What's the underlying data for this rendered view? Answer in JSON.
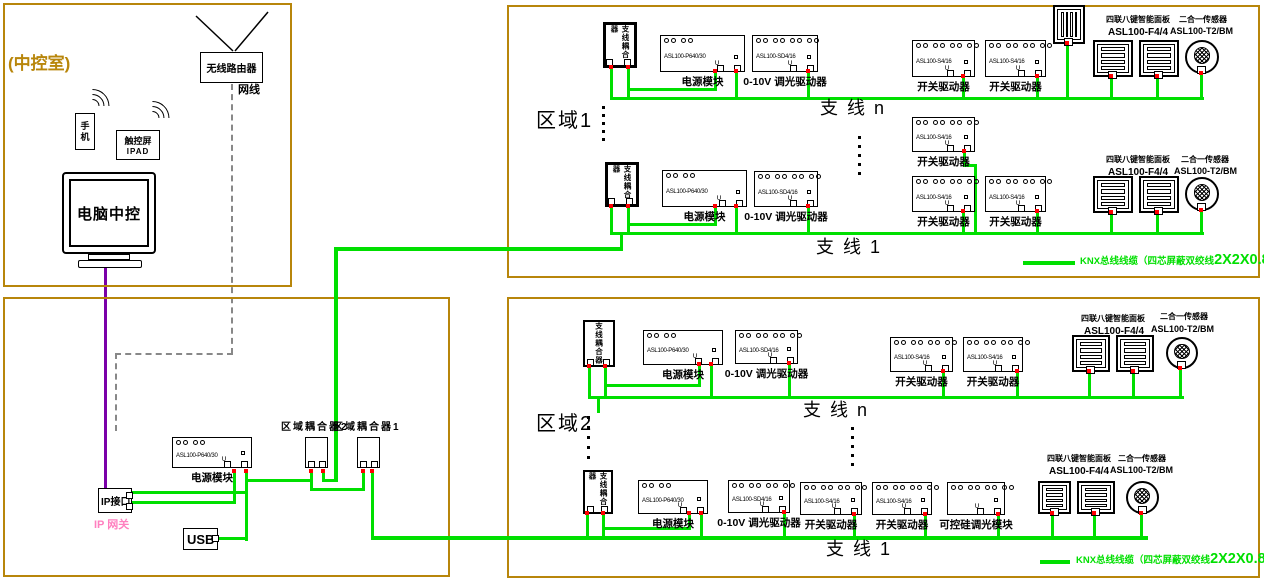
{
  "colors": {
    "frame": "#B8860B",
    "wire": "#00DF00",
    "purple": "#7A00A8",
    "pink": "#FF7FBF",
    "red": "#FF0000",
    "dash": "#888888"
  },
  "control_room": {
    "title": "(中控室)",
    "router": "无线路由器",
    "cable": "网线",
    "phone": "手机",
    "touchscreen": "触控屏",
    "touchscreen_sub": "IPAD",
    "pc": "电脑中控"
  },
  "legend": {
    "a": "KNX总线线缆（四芯屏蔽双绞线",
    "b": "2X2X0.8",
    "c": "）"
  },
  "legends": [
    {
      "x": 1023,
      "y": 261,
      "lw": 52,
      "tx": 1080,
      "ty": 252
    },
    {
      "x": 1040,
      "y": 560,
      "lw": 30,
      "tx": 1076,
      "ty": 551
    }
  ],
  "frames": [
    {
      "name": "control-room-frame",
      "x": 3,
      "y": 3,
      "w": 289,
      "h": 284
    },
    {
      "name": "gateway-frame",
      "x": 3,
      "y": 297,
      "w": 447,
      "h": 280
    },
    {
      "name": "zone1-frame",
      "x": 507,
      "y": 5,
      "w": 753,
      "h": 273
    },
    {
      "name": "zone2-frame",
      "x": 507,
      "y": 297,
      "w": 753,
      "h": 281
    }
  ],
  "devices": [
    {
      "n": "gw-power-module",
      "t": "module",
      "x": 172,
      "y": 437,
      "w": 80,
      "h": 31,
      "label": "电源模块",
      "model": "ASL100-P640/30",
      "tops": 4
    },
    {
      "n": "zone-coupler-2",
      "t": "coupler_s",
      "x": 305,
      "y": 437,
      "w": 23,
      "h": 31
    },
    {
      "n": "zone-coupler-1",
      "t": "coupler_s",
      "x": 357,
      "y": 437,
      "w": 23,
      "h": 31
    },
    {
      "n": "ip-interface-box",
      "t": "ipbox",
      "x": 98,
      "y": 488,
      "w": 34,
      "h": 25,
      "label": "IP接口"
    },
    {
      "n": "usb-interface-box",
      "t": "usbbox",
      "x": 183,
      "y": 528,
      "w": 35,
      "h": 22,
      "label": "USB"
    },
    {
      "n": "z1r1-branch-coupler",
      "t": "coupler_v",
      "x": 603,
      "y": 22,
      "w": 34,
      "h": 46,
      "label": "支线耦合器",
      "bw": 3
    },
    {
      "n": "z1r1-power-module",
      "t": "module",
      "x": 660,
      "y": 35,
      "w": 85,
      "h": 37,
      "label": "电源模块",
      "model": "ASL100-P640/30",
      "tops": 4
    },
    {
      "n": "z1r1-dimmer-driver",
      "t": "module",
      "x": 752,
      "y": 35,
      "w": 66,
      "h": 37,
      "label": "0-10V 调光驱动器",
      "model": "ASL100-SD4/16",
      "tops": 8
    },
    {
      "n": "z1r1-switch-driver-1",
      "t": "module",
      "x": 912,
      "y": 40,
      "w": 63,
      "h": 37,
      "label": "开关驱动器",
      "model": "ASL100-S4/16",
      "tops": 8
    },
    {
      "n": "z1r1-switch-driver-2",
      "t": "module",
      "x": 985,
      "y": 40,
      "w": 61,
      "h": 37,
      "label": "开关驱动器",
      "model": "ASL100-S4/16",
      "tops": 8
    },
    {
      "n": "z1r1-panel-top",
      "t": "panel_rot",
      "x": 1053,
      "y": 5,
      "w": 32,
      "h": 39
    },
    {
      "n": "z1r1-panel-1",
      "t": "panel",
      "x": 1093,
      "y": 40,
      "w": 40,
      "h": 37
    },
    {
      "n": "z1r1-panel-2",
      "t": "panel",
      "x": 1139,
      "y": 40,
      "w": 40,
      "h": 37
    },
    {
      "n": "z1r1-sensor",
      "t": "sensor",
      "x": 1185,
      "y": 40,
      "w": 34,
      "h": 34
    },
    {
      "n": "z1-mid-switch-driver",
      "t": "module",
      "x": 912,
      "y": 117,
      "w": 63,
      "h": 35,
      "label": "开关驱动器",
      "model": "ASL100-S4/16",
      "tops": 8
    },
    {
      "n": "z1r2-branch-coupler",
      "t": "coupler_v",
      "x": 605,
      "y": 162,
      "w": 34,
      "h": 45,
      "label": "支线耦合器",
      "bw": 3
    },
    {
      "n": "z1r2-power-module",
      "t": "module",
      "x": 662,
      "y": 170,
      "w": 85,
      "h": 37,
      "label": "电源模块",
      "model": "ASL100-P640/30",
      "tops": 4
    },
    {
      "n": "z1r2-dimmer-driver",
      "t": "module",
      "x": 754,
      "y": 171,
      "w": 64,
      "h": 36,
      "label": "0-10V 调光驱动器",
      "model": "ASL100-SD4/16",
      "tops": 8
    },
    {
      "n": "z1r2-switch-driver-1",
      "t": "module",
      "x": 912,
      "y": 176,
      "w": 63,
      "h": 36,
      "label": "开关驱动器",
      "model": "ASL100-S4/16",
      "tops": 8
    },
    {
      "n": "z1r2-switch-driver-2",
      "t": "module",
      "x": 985,
      "y": 176,
      "w": 61,
      "h": 36,
      "label": "开关驱动器",
      "model": "ASL100-S4/16",
      "tops": 8
    },
    {
      "n": "z1r2-panel-1",
      "t": "panel",
      "x": 1093,
      "y": 176,
      "w": 40,
      "h": 37
    },
    {
      "n": "z1r2-panel-2",
      "t": "panel",
      "x": 1139,
      "y": 176,
      "w": 40,
      "h": 37
    },
    {
      "n": "z1r2-sensor",
      "t": "sensor",
      "x": 1185,
      "y": 177,
      "w": 34,
      "h": 34
    },
    {
      "n": "z2r1-branch-coupler",
      "t": "coupler_v",
      "x": 583,
      "y": 320,
      "w": 32,
      "h": 47,
      "label": "支线耦合器",
      "bw": 2
    },
    {
      "n": "z2r1-power-module",
      "t": "module",
      "x": 643,
      "y": 330,
      "w": 80,
      "h": 35,
      "label": "电源模块",
      "model": "ASL100-P640/30",
      "tops": 4
    },
    {
      "n": "z2r1-dimmer-driver",
      "t": "module",
      "x": 735,
      "y": 330,
      "w": 63,
      "h": 34,
      "label": "0-10V 调光驱动器",
      "model": "ASL100-SD4/16",
      "tops": 8
    },
    {
      "n": "z2r1-switch-driver-1",
      "t": "module",
      "x": 890,
      "y": 337,
      "w": 63,
      "h": 35,
      "label": "开关驱动器",
      "model": "ASL100-S4/16",
      "tops": 8
    },
    {
      "n": "z2r1-switch-driver-2",
      "t": "module",
      "x": 963,
      "y": 337,
      "w": 60,
      "h": 35,
      "label": "开关驱动器",
      "model": "ASL100-S4/16",
      "tops": 8
    },
    {
      "n": "z2r1-panel-1",
      "t": "panel",
      "x": 1072,
      "y": 335,
      "w": 38,
      "h": 37
    },
    {
      "n": "z2r1-panel-2",
      "t": "panel",
      "x": 1116,
      "y": 335,
      "w": 38,
      "h": 37
    },
    {
      "n": "z2r1-sensor",
      "t": "sensor",
      "x": 1166,
      "y": 337,
      "w": 32,
      "h": 32
    },
    {
      "n": "z2r2-branch-coupler",
      "t": "coupler_v",
      "x": 583,
      "y": 470,
      "w": 30,
      "h": 44,
      "label": "支线耦合器",
      "bw": 2
    },
    {
      "n": "z2r2-power-module",
      "t": "module",
      "x": 638,
      "y": 480,
      "w": 70,
      "h": 34,
      "label": "电源模块",
      "model": "ASL100-P640/30",
      "tops": 4
    },
    {
      "n": "z2r2-dimmer-driver",
      "t": "module",
      "x": 728,
      "y": 480,
      "w": 62,
      "h": 33,
      "label": "0-10V 调光驱动器",
      "model": "ASL100-SD4/16",
      "tops": 8
    },
    {
      "n": "z2r2-switch-driver-1",
      "t": "module",
      "x": 800,
      "y": 482,
      "w": 62,
      "h": 33,
      "label": "开关驱动器",
      "model": "ASL100-S4/16",
      "tops": 8
    },
    {
      "n": "z2r2-switch-driver-2",
      "t": "module",
      "x": 872,
      "y": 482,
      "w": 60,
      "h": 33,
      "label": "开关驱动器",
      "model": "ASL100-S4/16",
      "tops": 8
    },
    {
      "n": "z2r2-thyristor-dimmer",
      "t": "module",
      "x": 947,
      "y": 482,
      "w": 58,
      "h": 33,
      "label": "可控硅调光模块",
      "tops": 8
    },
    {
      "n": "z2r2-panel-1",
      "t": "panel",
      "x": 1038,
      "y": 481,
      "w": 33,
      "h": 33
    },
    {
      "n": "z2r2-panel-2",
      "t": "panel",
      "x": 1077,
      "y": 481,
      "w": 38,
      "h": 33
    },
    {
      "n": "z2r2-sensor",
      "t": "sensor",
      "x": 1126,
      "y": 481,
      "w": 33,
      "h": 33
    }
  ],
  "wires": [
    [
      132,
      491,
      116,
      3,
      0
    ],
    [
      132,
      501,
      104,
      3,
      0
    ],
    [
      233,
      470,
      3,
      34,
      1
    ],
    [
      245,
      470,
      3,
      71,
      1
    ],
    [
      218,
      537,
      30,
      3,
      0
    ],
    [
      248,
      479,
      64,
      3,
      0
    ],
    [
      310,
      470,
      3,
      21,
      1
    ],
    [
      310,
      488,
      55,
      3,
      0
    ],
    [
      362,
      470,
      3,
      21,
      1
    ],
    [
      322,
      470,
      3,
      12,
      1
    ],
    [
      322,
      479,
      15,
      3,
      0
    ],
    [
      334,
      248,
      4,
      234,
      0
    ],
    [
      371,
      470,
      3,
      70,
      1
    ],
    [
      334,
      247,
      289,
      4,
      0
    ],
    [
      371,
      536,
      777,
      4,
      0
    ],
    [
      610,
      97,
      594,
      3,
      0
    ],
    [
      610,
      66,
      3,
      31,
      1
    ],
    [
      627,
      66,
      3,
      31,
      1
    ],
    [
      714,
      70,
      3,
      20,
      1
    ],
    [
      629,
      88,
      88,
      3,
      0
    ],
    [
      735,
      70,
      3,
      27,
      1
    ],
    [
      807,
      70,
      3,
      27,
      1
    ],
    [
      962,
      75,
      3,
      22,
      1
    ],
    [
      1036,
      75,
      3,
      22,
      1
    ],
    [
      1066,
      42,
      3,
      55,
      1
    ],
    [
      1110,
      75,
      3,
      22,
      1
    ],
    [
      1156,
      75,
      3,
      22,
      1
    ],
    [
      1200,
      72,
      3,
      25,
      1
    ],
    [
      963,
      150,
      3,
      17,
      1
    ],
    [
      963,
      164,
      14,
      3,
      0
    ],
    [
      974,
      164,
      3,
      70,
      0
    ],
    [
      610,
      232,
      594,
      3,
      0
    ],
    [
      620,
      232,
      3,
      16,
      0
    ],
    [
      610,
      205,
      3,
      27,
      1
    ],
    [
      627,
      205,
      3,
      27,
      1
    ],
    [
      714,
      205,
      3,
      19,
      1
    ],
    [
      629,
      223,
      88,
      3,
      0
    ],
    [
      735,
      205,
      3,
      27,
      1
    ],
    [
      807,
      205,
      3,
      27,
      1
    ],
    [
      962,
      210,
      3,
      22,
      1
    ],
    [
      1036,
      210,
      3,
      22,
      1
    ],
    [
      1110,
      211,
      3,
      21,
      1
    ],
    [
      1156,
      211,
      3,
      21,
      1
    ],
    [
      1200,
      209,
      3,
      23,
      1
    ],
    [
      588,
      396,
      596,
      3,
      0
    ],
    [
      588,
      365,
      3,
      31,
      1
    ],
    [
      604,
      365,
      3,
      31,
      1
    ],
    [
      698,
      363,
      3,
      23,
      1
    ],
    [
      606,
      384,
      95,
      3,
      0
    ],
    [
      710,
      363,
      3,
      33,
      1
    ],
    [
      788,
      362,
      3,
      34,
      1
    ],
    [
      942,
      370,
      3,
      26,
      1
    ],
    [
      1016,
      370,
      3,
      26,
      1
    ],
    [
      1088,
      370,
      3,
      26,
      1
    ],
    [
      1132,
      370,
      3,
      26,
      1
    ],
    [
      1179,
      367,
      3,
      29,
      1
    ],
    [
      597,
      399,
      3,
      14,
      0
    ],
    [
      586,
      512,
      3,
      24,
      1
    ],
    [
      602,
      512,
      3,
      24,
      1
    ],
    [
      688,
      512,
      3,
      17,
      1
    ],
    [
      604,
      527,
      87,
      3,
      0
    ],
    [
      700,
      512,
      3,
      24,
      1
    ],
    [
      783,
      511,
      3,
      25,
      1
    ],
    [
      853,
      513,
      3,
      23,
      1
    ],
    [
      924,
      513,
      3,
      23,
      1
    ],
    [
      997,
      513,
      3,
      23,
      1
    ],
    [
      1051,
      512,
      3,
      24,
      1
    ],
    [
      1093,
      512,
      3,
      24,
      1
    ],
    [
      1140,
      512,
      3,
      24,
      1
    ]
  ],
  "dots": [
    {
      "x": 602,
      "y": 106,
      "n": 5,
      "g": 8
    },
    {
      "x": 858,
      "y": 136,
      "n": 5,
      "g": 9
    },
    {
      "x": 587,
      "y": 416,
      "n": 5,
      "g": 10
    },
    {
      "x": 851,
      "y": 427,
      "n": 5,
      "g": 9
    }
  ],
  "texts": [
    {
      "t": "区域耦合器2",
      "x": 281,
      "y": 422,
      "s": 10,
      "b": 1
    },
    {
      "t": "区域耦合器1",
      "x": 333,
      "y": 422,
      "s": 10,
      "b": 1
    },
    {
      "t": "IP 网关",
      "x": 94,
      "y": 519,
      "s": 11,
      "c": "#FF7FBF",
      "b": 1
    },
    {
      "t": "区域1",
      "x": 536,
      "y": 110,
      "s": 20
    },
    {
      "t": "支 线 n",
      "x": 820,
      "y": 99,
      "s": 18
    },
    {
      "t": "支 线 1",
      "x": 816,
      "y": 238,
      "s": 18
    },
    {
      "t": "区域2",
      "x": 536,
      "y": 413,
      "s": 20
    },
    {
      "t": "支 线 n",
      "x": 803,
      "y": 401,
      "s": 18
    },
    {
      "t": "支 线 1",
      "x": 826,
      "y": 540,
      "s": 18
    },
    {
      "t": "四联八键智能面板",
      "x": 1106,
      "y": 16,
      "s": 8,
      "b": 1
    },
    {
      "t": "ASL100-F4/4",
      "x": 1108,
      "y": 27,
      "s": 10,
      "b": 1
    },
    {
      "t": "二合一传感器",
      "x": 1179,
      "y": 16,
      "s": 8,
      "b": 1
    },
    {
      "t": "ASL100-T2/BM",
      "x": 1170,
      "y": 27,
      "s": 9,
      "b": 1
    },
    {
      "t": "四联八键智能面板",
      "x": 1106,
      "y": 156,
      "s": 8,
      "b": 1
    },
    {
      "t": "ASL100-F4/4",
      "x": 1108,
      "y": 167,
      "s": 10,
      "b": 1
    },
    {
      "t": "二合一传感器",
      "x": 1181,
      "y": 156,
      "s": 8,
      "b": 1
    },
    {
      "t": "ASL100-T2/BM",
      "x": 1174,
      "y": 167,
      "s": 9,
      "b": 1
    },
    {
      "t": "四联八键智能面板",
      "x": 1081,
      "y": 315,
      "s": 8,
      "b": 1
    },
    {
      "t": "ASL100-F4/4",
      "x": 1084,
      "y": 326,
      "s": 10,
      "b": 1
    },
    {
      "t": "二合一传感器",
      "x": 1160,
      "y": 313,
      "s": 8,
      "b": 1
    },
    {
      "t": "ASL100-T2/BM",
      "x": 1151,
      "y": 325,
      "s": 9,
      "b": 1
    },
    {
      "t": "四联八键智能面板",
      "x": 1047,
      "y": 455,
      "s": 8,
      "b": 1
    },
    {
      "t": "ASL100-F4/4",
      "x": 1049,
      "y": 466,
      "s": 10,
      "b": 1
    },
    {
      "t": "二合一传感器",
      "x": 1118,
      "y": 455,
      "s": 8,
      "b": 1
    },
    {
      "t": "ASL100-T2/BM",
      "x": 1110,
      "y": 466,
      "s": 9,
      "b": 1
    }
  ]
}
